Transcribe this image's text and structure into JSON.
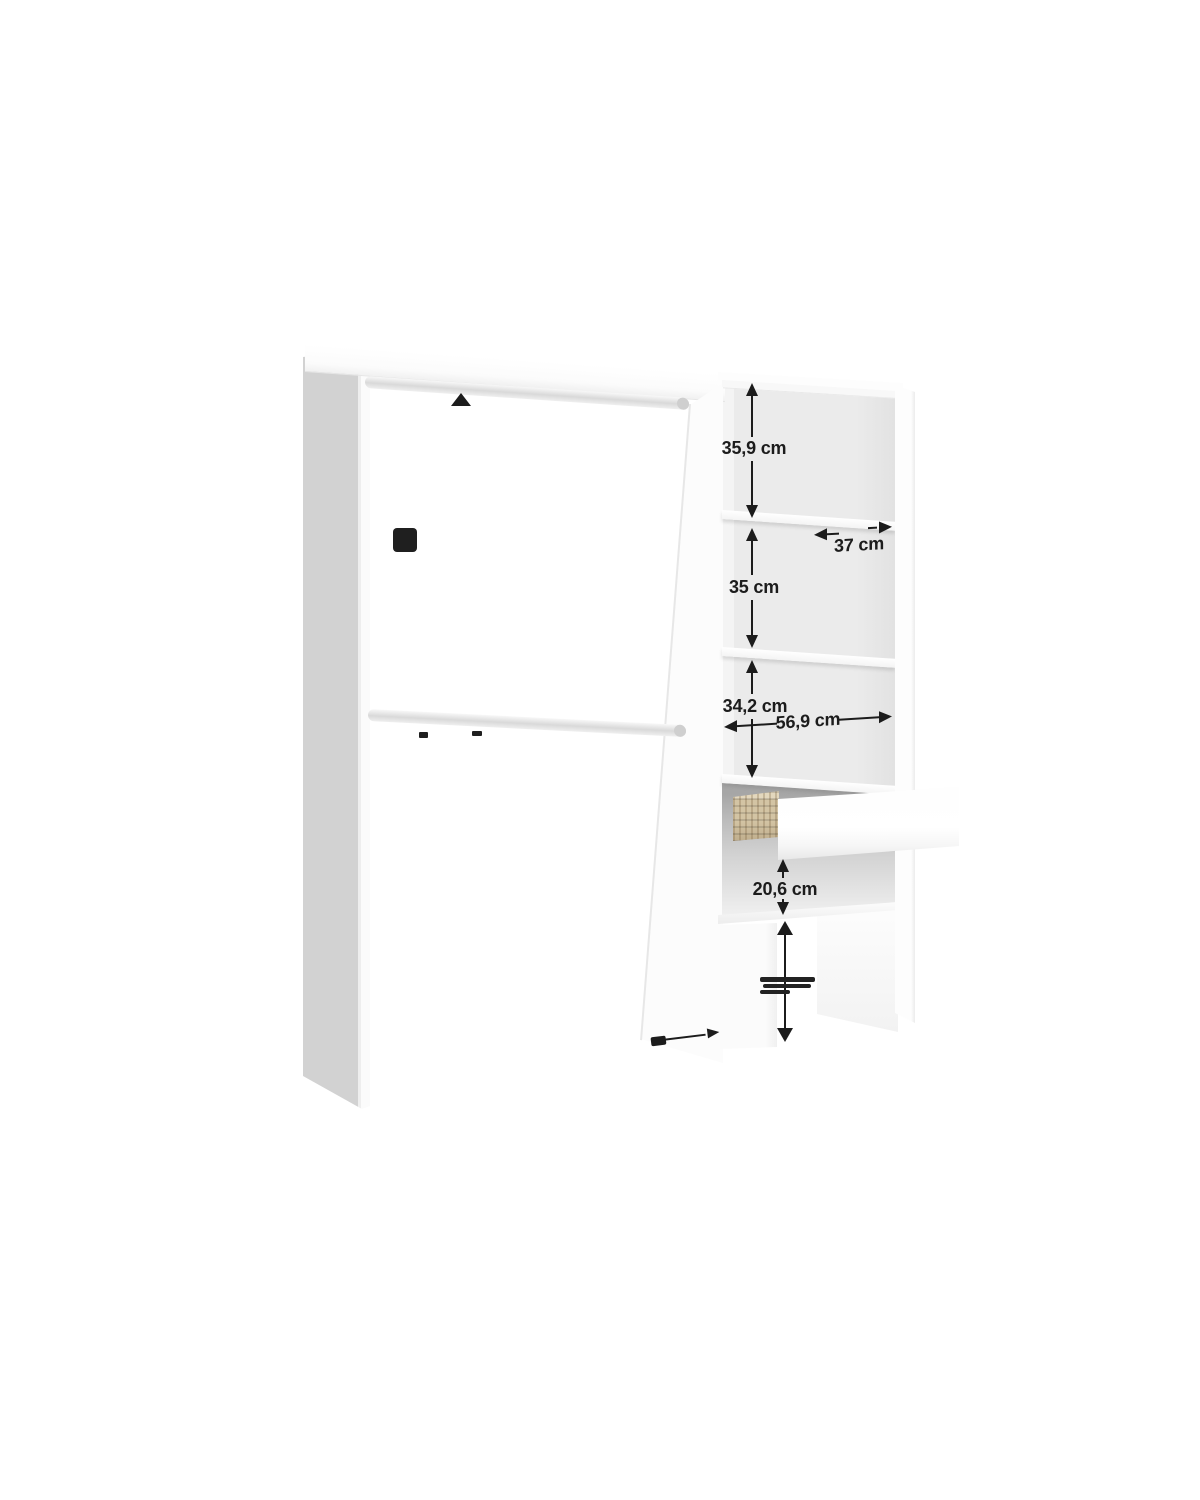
{
  "diagram": {
    "background_color": "#ffffff",
    "annotation_color": "#1c1c1c",
    "labels": {
      "top_compartment_height": "35,9 cm",
      "shelf_depth": "37 cm",
      "middle_compartment_height": "35 cm",
      "lower_compartment_height": "34,2 cm",
      "interior_width": "56,9 cm",
      "drawer_compartment_height": "20,6 cm"
    },
    "colors": {
      "panel_face": "#fcfcfc",
      "panel_side": "#d2d2d2",
      "interior_back": "#eaeaea",
      "drawer_cavity": "#a6a6a6",
      "basket_tan": "#d3c4a4"
    }
  }
}
